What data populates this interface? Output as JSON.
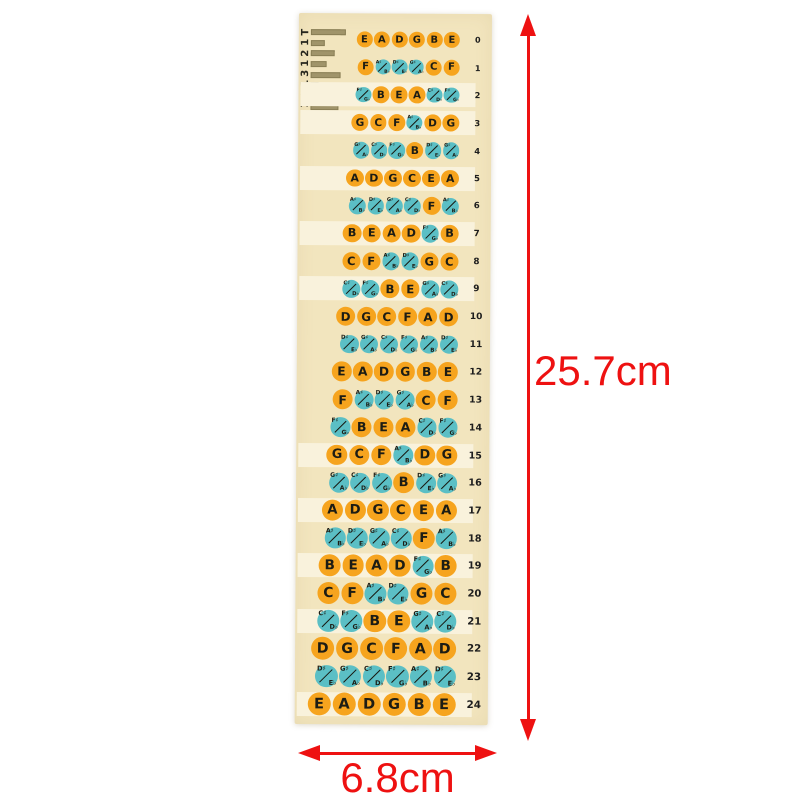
{
  "dimensions": {
    "height": "25.7cm",
    "width": "6.8cm"
  },
  "product": {
    "code_text": "T1213121",
    "bar_widths": [
      35,
      14,
      24,
      16,
      30,
      8,
      20,
      28
    ],
    "colors": {
      "sheet": "#F2E5BE",
      "strip": "#F9F2DC",
      "natural": "#F6A41E",
      "accidental": "#5BBFC5",
      "ink": "#1C1C14",
      "bar": "#A0946A",
      "dimension": "#EE1111",
      "background": "#FFFFFF"
    },
    "frets": [
      {
        "fret": "0",
        "highlight": false,
        "notes": [
          {
            "n": "E"
          },
          {
            "n": "A"
          },
          {
            "n": "D"
          },
          {
            "n": "G"
          },
          {
            "n": "B"
          },
          {
            "n": "E"
          }
        ]
      },
      {
        "fret": "1",
        "highlight": false,
        "notes": [
          {
            "n": "F"
          },
          {
            "s": "A♯",
            "f": "B♭"
          },
          {
            "s": "D♯",
            "f": "E♭"
          },
          {
            "s": "G♯",
            "f": "A♭"
          },
          {
            "n": "C"
          },
          {
            "n": "F"
          }
        ]
      },
      {
        "fret": "2",
        "highlight": true,
        "notes": [
          {
            "s": "F♯",
            "f": "G♭"
          },
          {
            "n": "B"
          },
          {
            "n": "E"
          },
          {
            "n": "A"
          },
          {
            "s": "C♯",
            "f": "D♭"
          },
          {
            "s": "F♯",
            "f": "G♭"
          }
        ]
      },
      {
        "fret": "3",
        "highlight": true,
        "notes": [
          {
            "n": "G"
          },
          {
            "n": "C"
          },
          {
            "n": "F"
          },
          {
            "s": "A♯",
            "f": "B♭"
          },
          {
            "n": "D"
          },
          {
            "n": "G"
          }
        ]
      },
      {
        "fret": "4",
        "highlight": false,
        "notes": [
          {
            "s": "G♯",
            "f": "A♭"
          },
          {
            "s": "C♯",
            "f": "D♭"
          },
          {
            "s": "F♯",
            "f": "G♭"
          },
          {
            "n": "B"
          },
          {
            "s": "D♯",
            "f": "E♭"
          },
          {
            "s": "G♯",
            "f": "A♭"
          }
        ]
      },
      {
        "fret": "5",
        "highlight": true,
        "notes": [
          {
            "n": "A"
          },
          {
            "n": "D"
          },
          {
            "n": "G"
          },
          {
            "n": "C"
          },
          {
            "n": "E"
          },
          {
            "n": "A"
          }
        ]
      },
      {
        "fret": "6",
        "highlight": false,
        "notes": [
          {
            "s": "A♯",
            "f": "B♭"
          },
          {
            "s": "D♯",
            "f": "E♭"
          },
          {
            "s": "G♯",
            "f": "A♭"
          },
          {
            "s": "C♯",
            "f": "D♭"
          },
          {
            "n": "F"
          },
          {
            "s": "A♯",
            "f": "B♭"
          }
        ]
      },
      {
        "fret": "7",
        "highlight": true,
        "notes": [
          {
            "n": "B"
          },
          {
            "n": "E"
          },
          {
            "n": "A"
          },
          {
            "n": "D"
          },
          {
            "s": "F♯",
            "f": "G♭"
          },
          {
            "n": "B"
          }
        ]
      },
      {
        "fret": "8",
        "highlight": false,
        "notes": [
          {
            "n": "C"
          },
          {
            "n": "F"
          },
          {
            "s": "A♯",
            "f": "B♭"
          },
          {
            "s": "D♯",
            "f": "E♭"
          },
          {
            "n": "G"
          },
          {
            "n": "C"
          }
        ]
      },
      {
        "fret": "9",
        "highlight": true,
        "notes": [
          {
            "s": "C♯",
            "f": "D♭"
          },
          {
            "s": "F♯",
            "f": "G♭"
          },
          {
            "n": "B"
          },
          {
            "n": "E"
          },
          {
            "s": "G♯",
            "f": "A♭"
          },
          {
            "s": "C♯",
            "f": "D♭"
          }
        ]
      },
      {
        "fret": "10",
        "highlight": false,
        "notes": [
          {
            "n": "D"
          },
          {
            "n": "G"
          },
          {
            "n": "C"
          },
          {
            "n": "F"
          },
          {
            "n": "A"
          },
          {
            "n": "D"
          }
        ]
      },
      {
        "fret": "11",
        "highlight": false,
        "notes": [
          {
            "s": "D♯",
            "f": "E♭"
          },
          {
            "s": "G♯",
            "f": "A♭"
          },
          {
            "s": "C♯",
            "f": "D♭"
          },
          {
            "s": "F♯",
            "f": "G♭"
          },
          {
            "s": "A♯",
            "f": "B♭"
          },
          {
            "s": "D♯",
            "f": "E♭"
          }
        ]
      },
      {
        "fret": "12",
        "highlight": false,
        "notes": [
          {
            "n": "E"
          },
          {
            "n": "A"
          },
          {
            "n": "D"
          },
          {
            "n": "G"
          },
          {
            "n": "B"
          },
          {
            "n": "E"
          }
        ]
      },
      {
        "fret": "13",
        "highlight": false,
        "notes": [
          {
            "n": "F"
          },
          {
            "s": "A♯",
            "f": "B♭"
          },
          {
            "s": "D♯",
            "f": "E♭"
          },
          {
            "s": "G♯",
            "f": "A♭"
          },
          {
            "n": "C"
          },
          {
            "n": "F"
          }
        ]
      },
      {
        "fret": "14",
        "highlight": false,
        "notes": [
          {
            "s": "F♯",
            "f": "G♭"
          },
          {
            "n": "B"
          },
          {
            "n": "E"
          },
          {
            "n": "A"
          },
          {
            "s": "C♯",
            "f": "D♭"
          },
          {
            "s": "F♯",
            "f": "G♭"
          }
        ]
      },
      {
        "fret": "15",
        "highlight": true,
        "notes": [
          {
            "n": "G"
          },
          {
            "n": "C"
          },
          {
            "n": "F"
          },
          {
            "s": "A♯",
            "f": "B♭"
          },
          {
            "n": "D"
          },
          {
            "n": "G"
          }
        ]
      },
      {
        "fret": "16",
        "highlight": false,
        "notes": [
          {
            "s": "G♯",
            "f": "A♭"
          },
          {
            "s": "C♯",
            "f": "D♭"
          },
          {
            "s": "F♯",
            "f": "G♭"
          },
          {
            "n": "B"
          },
          {
            "s": "D♯",
            "f": "E♭"
          },
          {
            "s": "G♯",
            "f": "A♭"
          }
        ]
      },
      {
        "fret": "17",
        "highlight": true,
        "notes": [
          {
            "n": "A"
          },
          {
            "n": "D"
          },
          {
            "n": "G"
          },
          {
            "n": "C"
          },
          {
            "n": "E"
          },
          {
            "n": "A"
          }
        ]
      },
      {
        "fret": "18",
        "highlight": false,
        "notes": [
          {
            "s": "A♯",
            "f": "B♭"
          },
          {
            "s": "D♯",
            "f": "E♭"
          },
          {
            "s": "G♯",
            "f": "A♭"
          },
          {
            "s": "C♯",
            "f": "D♭"
          },
          {
            "n": "F"
          },
          {
            "s": "A♯",
            "f": "B♭"
          }
        ]
      },
      {
        "fret": "19",
        "highlight": true,
        "notes": [
          {
            "n": "B"
          },
          {
            "n": "E"
          },
          {
            "n": "A"
          },
          {
            "n": "D"
          },
          {
            "s": "F♯",
            "f": "G♭"
          },
          {
            "n": "B"
          }
        ]
      },
      {
        "fret": "20",
        "highlight": false,
        "notes": [
          {
            "n": "C"
          },
          {
            "n": "F"
          },
          {
            "s": "A♯",
            "f": "B♭"
          },
          {
            "s": "D♯",
            "f": "E♭"
          },
          {
            "n": "G"
          },
          {
            "n": "C"
          }
        ]
      },
      {
        "fret": "21",
        "highlight": true,
        "notes": [
          {
            "s": "C♯",
            "f": "D♭"
          },
          {
            "s": "F♯",
            "f": "G♭"
          },
          {
            "n": "B"
          },
          {
            "n": "E"
          },
          {
            "s": "G♯",
            "f": "A♭"
          },
          {
            "s": "C♯",
            "f": "D♭"
          }
        ]
      },
      {
        "fret": "22",
        "highlight": false,
        "notes": [
          {
            "n": "D"
          },
          {
            "n": "G"
          },
          {
            "n": "C"
          },
          {
            "n": "F"
          },
          {
            "n": "A"
          },
          {
            "n": "D"
          }
        ]
      },
      {
        "fret": "23",
        "highlight": false,
        "notes": [
          {
            "s": "D♯",
            "f": "E♭"
          },
          {
            "s": "G♯",
            "f": "A♭"
          },
          {
            "s": "C♯",
            "f": "D♭"
          },
          {
            "s": "F♯",
            "f": "G♭"
          },
          {
            "s": "A♯",
            "f": "B♭"
          },
          {
            "s": "D♯",
            "f": "E♭"
          }
        ]
      },
      {
        "fret": "24",
        "highlight": true,
        "notes": [
          {
            "n": "E"
          },
          {
            "n": "A"
          },
          {
            "n": "D"
          },
          {
            "n": "G"
          },
          {
            "n": "B"
          },
          {
            "n": "E"
          }
        ]
      }
    ]
  }
}
